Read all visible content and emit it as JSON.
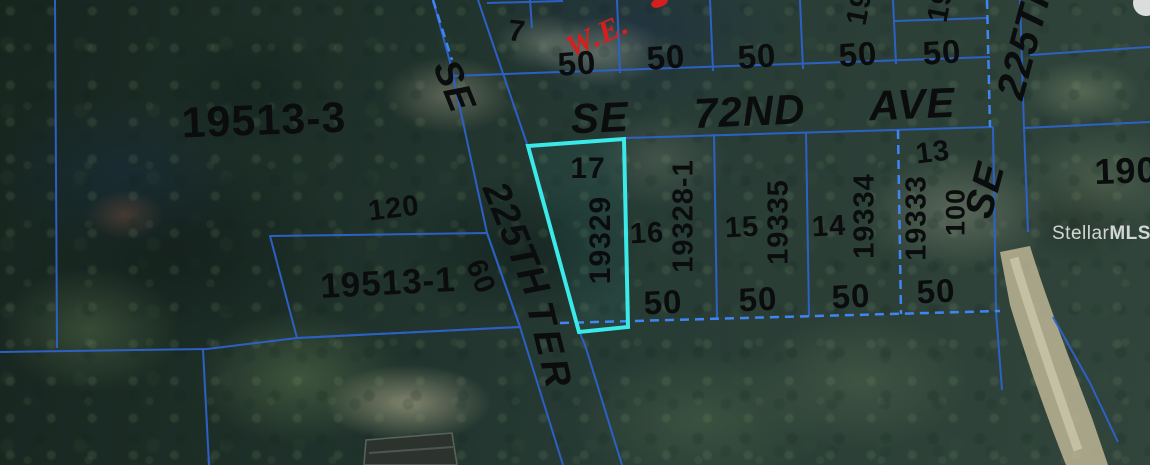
{
  "streets": {
    "main_avenue": "SE  72ND  AVE",
    "left_vertical": "SE  225TH",
    "left_vertical_suffix": "TER",
    "right_vertical": "SE  225TH"
  },
  "easement": {
    "label": "W.E."
  },
  "parcels": {
    "region_west": "19513-3",
    "region_southwest": "19513-1",
    "north_lot_number": "7",
    "lot17": {
      "lot": "17",
      "id": "19329"
    },
    "lot16": {
      "lot": "16",
      "id": "19328-1"
    },
    "lot15": {
      "lot": "15",
      "id": "19335"
    },
    "lot14": {
      "lot": "14",
      "id": "19334"
    },
    "lot13": {
      "lot": "13",
      "id": "19333",
      "depth": "100"
    },
    "partial_right": "190",
    "partial_north_a": "19",
    "partial_north_b": "19"
  },
  "dimensions": {
    "north_row": [
      "50",
      "50",
      "50",
      "50",
      "50"
    ],
    "south_row": [
      "50",
      "50",
      "50",
      "50"
    ],
    "west_depth": "120",
    "street_frontage": "60"
  },
  "watermark": {
    "brand": "Stellar",
    "suffix": "MLS"
  },
  "colors": {
    "parcel_line": "#2d63cc",
    "parcel_line_bright": "#4189ff",
    "highlight_outline": "#3be9e9",
    "easement_text": "#d51f1f",
    "label_text": "#0b0c0e",
    "road": "#c3b998",
    "watermark": "#ffffff"
  }
}
